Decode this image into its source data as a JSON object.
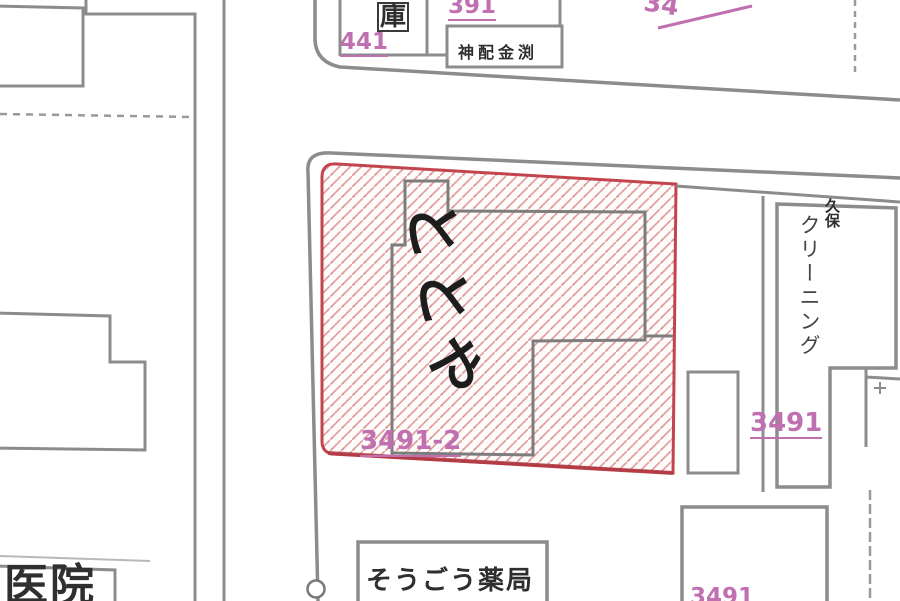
{
  "map": {
    "title": "cadastral-map-view",
    "labels": {
      "garage": "庫",
      "parcel_441": "441",
      "parcel_391": "391",
      "company": "神配金渕",
      "top_right_partial": "34",
      "totoya": "ととや",
      "parcel_3491_2": "3491-2",
      "parcel_3491": "3491",
      "kubo": "久保",
      "cleaning": "クリーニング",
      "pharmacy": "そうごう薬局",
      "clinic": "医院",
      "bottom_right_partial": "3491"
    },
    "colors": {
      "parcel_number_magenta": "#c06fb0",
      "selected_parcel_red": "#c2454d",
      "hatch_pink": "#e2a0a0",
      "map_line_gray": "#8c8c8c",
      "building_text_dark": "#2f2f2f"
    }
  }
}
